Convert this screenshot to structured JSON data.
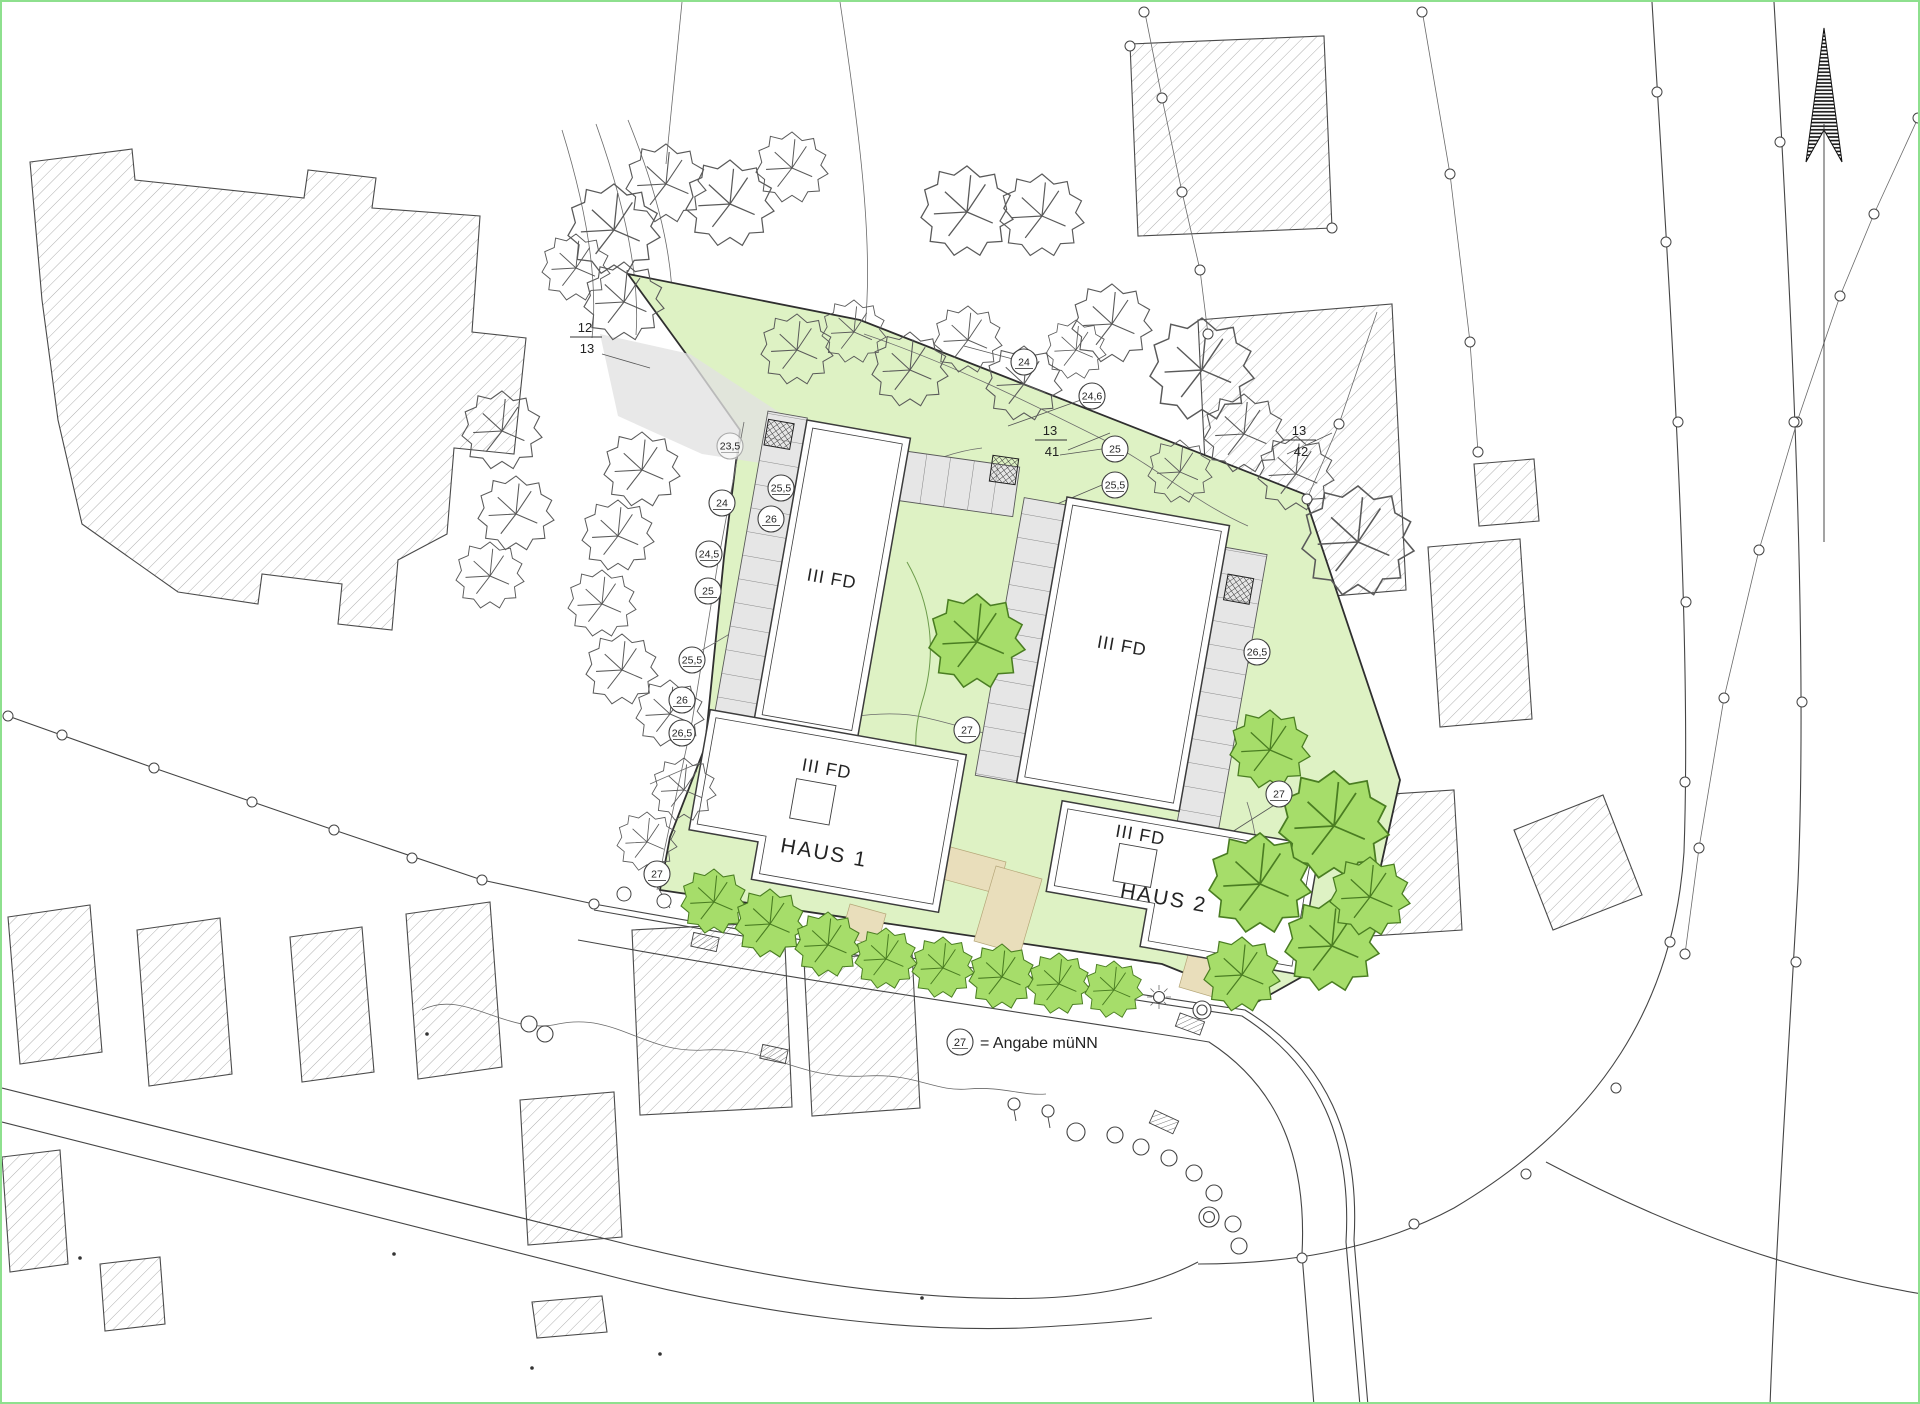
{
  "plan": {
    "labels": {
      "haus1": "HAUS 1",
      "haus2": "HAUS 2",
      "fd": "III FD",
      "legend_symbol": "27",
      "legend_text": "= Angabe müNN"
    },
    "parcels": [
      {
        "num": "12",
        "den": "13",
        "x": 583,
        "y": 330
      },
      {
        "num": "13",
        "den": "41",
        "x": 1048,
        "y": 433
      },
      {
        "num": "13",
        "den": "42",
        "x": 1297,
        "y": 433
      }
    ],
    "elevation_marks": [
      {
        "value": "23,5",
        "x": 728,
        "y": 444,
        "muted": true
      },
      {
        "value": "24",
        "x": 720,
        "y": 501
      },
      {
        "value": "24,5",
        "x": 707,
        "y": 552
      },
      {
        "value": "25",
        "x": 706,
        "y": 589
      },
      {
        "value": "25,5",
        "x": 690,
        "y": 658
      },
      {
        "value": "26",
        "x": 680,
        "y": 698
      },
      {
        "value": "26,5",
        "x": 680,
        "y": 731
      },
      {
        "value": "24",
        "x": 1022,
        "y": 360
      },
      {
        "value": "24,6",
        "x": 1090,
        "y": 394
      },
      {
        "value": "25",
        "x": 1113,
        "y": 447
      },
      {
        "value": "25,5",
        "x": 1113,
        "y": 483
      },
      {
        "value": "25,5",
        "x": 779,
        "y": 486
      },
      {
        "value": "26",
        "x": 769,
        "y": 517
      },
      {
        "value": "27",
        "x": 965,
        "y": 728
      },
      {
        "value": "26,5",
        "x": 1255,
        "y": 650
      },
      {
        "value": "27",
        "x": 1277,
        "y": 792
      },
      {
        "value": "27",
        "x": 655,
        "y": 872
      }
    ],
    "trees": {
      "filled": [
        [
          712,
          900,
          33
        ],
        [
          768,
          922,
          35
        ],
        [
          826,
          943,
          33
        ],
        [
          884,
          957,
          31
        ],
        [
          941,
          966,
          31
        ],
        [
          1000,
          975,
          33
        ],
        [
          1057,
          982,
          31
        ],
        [
          1112,
          988,
          29
        ],
        [
          1268,
          748,
          40
        ],
        [
          1332,
          824,
          55
        ],
        [
          1258,
          882,
          51
        ],
        [
          1330,
          944,
          47
        ],
        [
          1368,
          895,
          40
        ],
        [
          1240,
          973,
          38
        ],
        [
          975,
          640,
          48
        ]
      ],
      "outline": [
        [
          612,
          228,
          46
        ],
        [
          664,
          182,
          40
        ],
        [
          728,
          202,
          44
        ],
        [
          790,
          166,
          36
        ],
        [
          622,
          300,
          40
        ],
        [
          574,
          266,
          34
        ],
        [
          965,
          210,
          46
        ],
        [
          1040,
          214,
          42
        ],
        [
          1110,
          322,
          40
        ],
        [
          795,
          348,
          36
        ],
        [
          852,
          330,
          32
        ],
        [
          908,
          368,
          38
        ],
        [
          966,
          338,
          34
        ],
        [
          1022,
          382,
          38
        ],
        [
          1074,
          348,
          30
        ],
        [
          1200,
          368,
          52
        ],
        [
          1242,
          432,
          40
        ],
        [
          1294,
          472,
          38
        ],
        [
          1178,
          470,
          32
        ],
        [
          1356,
          540,
          56
        ],
        [
          500,
          429,
          40
        ],
        [
          514,
          512,
          38
        ],
        [
          488,
          574,
          34
        ],
        [
          640,
          468,
          38
        ],
        [
          616,
          534,
          36
        ],
        [
          600,
          602,
          34
        ],
        [
          620,
          668,
          36
        ],
        [
          668,
          712,
          34
        ],
        [
          682,
          788,
          32
        ],
        [
          645,
          840,
          30
        ]
      ]
    },
    "colors": {
      "site_green": "#def2c4",
      "tree_fill": "#a6dd6a",
      "tree_stroke": "#4a7d22",
      "path_tan": "#e9debb",
      "parking_gray": "#e6e6e6",
      "frame_green": "#8ee08e",
      "line": "#3c3c3c"
    }
  }
}
